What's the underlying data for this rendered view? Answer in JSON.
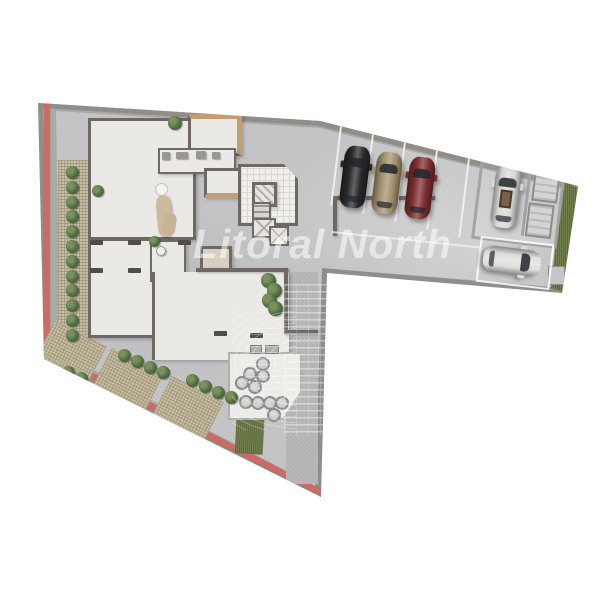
{
  "scene": {
    "type": "3D rendered architectural ground-floor site plan, top-down view",
    "background": "#ffffff"
  },
  "watermark": {
    "text": "Litoral North",
    "logo": "city-skyline-watermark",
    "color": "rgba(255,255,255,0.55)"
  },
  "site": {
    "colors": {
      "curb_red": "#cf6a62",
      "sidewalk_gray": "#ababa9",
      "outer_rim_gray": "#8e8e8c",
      "lot_concrete": "#c6c6c8",
      "floor_white": "#eae9e6",
      "wall_dark": "#6e6964",
      "paver_tan": "#c6bda3",
      "grass_green": "#71804c",
      "plant_green": "#4e6b42",
      "wood_trim": "#c49e6c",
      "deck_white": "#ecebe8",
      "walkway_gray": "#b9b9bb",
      "line_white": "#f2f2f0",
      "table_gray": "#c9c9c7",
      "glass_dark": "#20262c",
      "box_gray": "#d4d4d2"
    },
    "landscaping": {
      "left_shrub_row_count": 12,
      "diagonal_shrub_count": 10,
      "corner_hedge_count": 4,
      "indoor_plant_count": 3,
      "grass_patches": 2
    }
  },
  "building": {
    "depicted_areas": [
      "lobby-lounge",
      "stair-core",
      "elevator-shaft",
      "service-rooms",
      "garage-bays",
      "terrace-unit",
      "patio-deck"
    ],
    "patio_tables": 10,
    "wheel_stops": 7
  },
  "parking": {
    "painted_lines": 5,
    "storage_boxes": 2,
    "cars": [
      {
        "name": "hatchback-black",
        "color_hex": "#28282b",
        "orientation": "front-in",
        "row": "top"
      },
      {
        "name": "hatchback-tan",
        "color_hex": "#a38f6d",
        "orientation": "front-in",
        "row": "top"
      },
      {
        "name": "hatchback-red",
        "color_hex": "#7d2d30",
        "orientation": "front-in",
        "row": "top"
      },
      {
        "name": "suv-white",
        "color_hex": "#d9d9d6",
        "orientation": "front-in",
        "row": "right-bay",
        "sunroof_open": true
      },
      {
        "name": "sedan-white",
        "color_hex": "#dededc",
        "orientation": "side-parked",
        "row": "bottom-right"
      }
    ]
  }
}
